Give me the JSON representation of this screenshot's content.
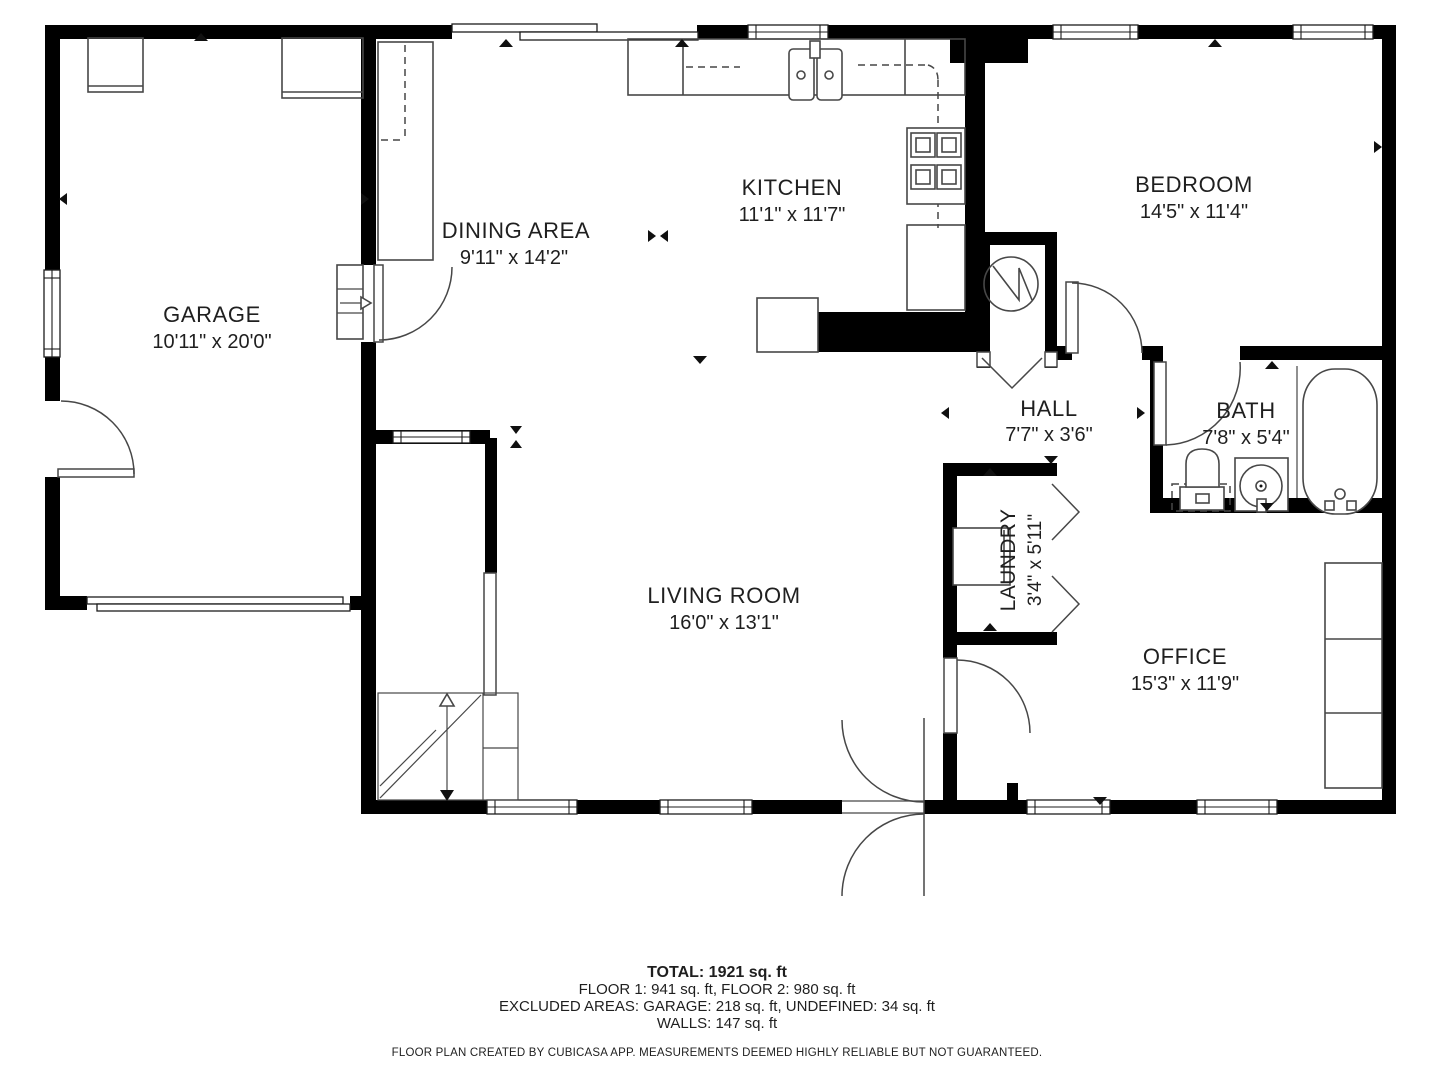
{
  "plan": {
    "rooms": {
      "garage": {
        "name": "GARAGE",
        "dims": "10'11\" x 20'0\""
      },
      "dining": {
        "name": "DINING AREA",
        "dims": "9'11\" x 14'2\""
      },
      "kitchen": {
        "name": "KITCHEN",
        "dims": "11'1\" x 11'7\""
      },
      "bedroom": {
        "name": "BEDROOM",
        "dims": "14'5\" x 11'4\""
      },
      "hall": {
        "name": "HALL",
        "dims": "7'7\" x 3'6\""
      },
      "bath": {
        "name": "BATH",
        "dims": "7'8\" x 5'4\""
      },
      "laundry": {
        "name": "LAUNDRY",
        "dims": "3'4\" x 5'11\""
      },
      "living": {
        "name": "LIVING ROOM",
        "dims": "16'0\" x 13'1\""
      },
      "office": {
        "name": "OFFICE",
        "dims": "15'3\" x 11'9\""
      }
    },
    "fixtures": [
      "kitchen-double-sink",
      "stove-4-burner",
      "kitchen-counters",
      "dining-counter",
      "garage-cabinets",
      "water-heater",
      "washer",
      "toilet",
      "bathroom-sink-vanity",
      "bathtub",
      "stairs-up",
      "garage-sectional-door",
      "entry-double-swing-door",
      "office-shelf"
    ],
    "colors": {
      "walls": "#000000",
      "background": "#ffffff",
      "fixture_lines": "#474747",
      "text": "#1f1f1f"
    }
  },
  "summary": {
    "total": "TOTAL: 1921 sq. ft",
    "floors": "FLOOR 1: 941 sq. ft, FLOOR 2: 980 sq. ft",
    "excluded": "EXCLUDED AREAS: GARAGE: 218 sq. ft, UNDEFINED: 34 sq. ft",
    "walls": "WALLS: 147 sq. ft",
    "disclaimer": "FLOOR PLAN CREATED BY CUBICASA APP. MEASUREMENTS DEEMED HIGHLY RELIABLE BUT NOT GUARANTEED."
  }
}
